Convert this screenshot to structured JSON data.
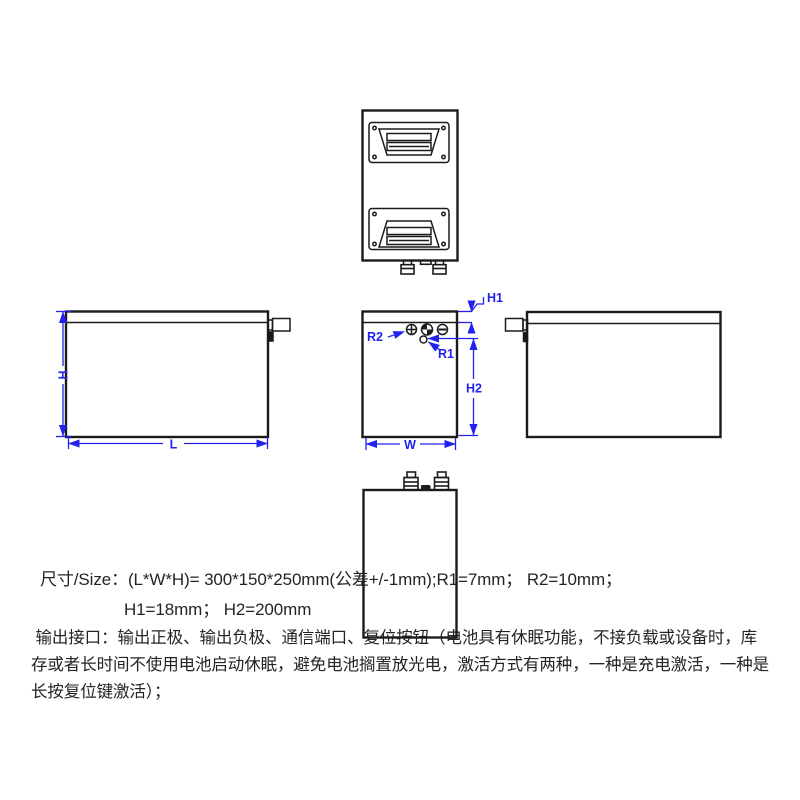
{
  "drawing": {
    "line_color": "#1b1b1b",
    "dimension_color": "#2222ee",
    "dim_labels": {
      "H": "H",
      "L": "L",
      "W": "W",
      "H1": "H1",
      "H2": "H2",
      "R1": "R1",
      "R2": "R2"
    },
    "port_symbols": {
      "positive": "+",
      "communication": "quadrant-circle",
      "negative": "-",
      "reset": "small-circle"
    }
  },
  "specs": {
    "size_line1": "尺寸/Size：(L*W*H)= 300*150*250mm(公差+/-1mm);R1=7mm； R2=10mm；",
    "size_line2": "H1=18mm； H2=200mm",
    "interface_lines": [
      " 输出接口：输出正极、输出负极、通信端口、复位按钮（电池具有休眠功能，不接负载或设备时，库",
      "存或者长时间不使用电池启动休眠，避免电池搁置放光电，激活方式有两种，一种是充电激活，一种是",
      "长按复位键激活）；"
    ]
  }
}
